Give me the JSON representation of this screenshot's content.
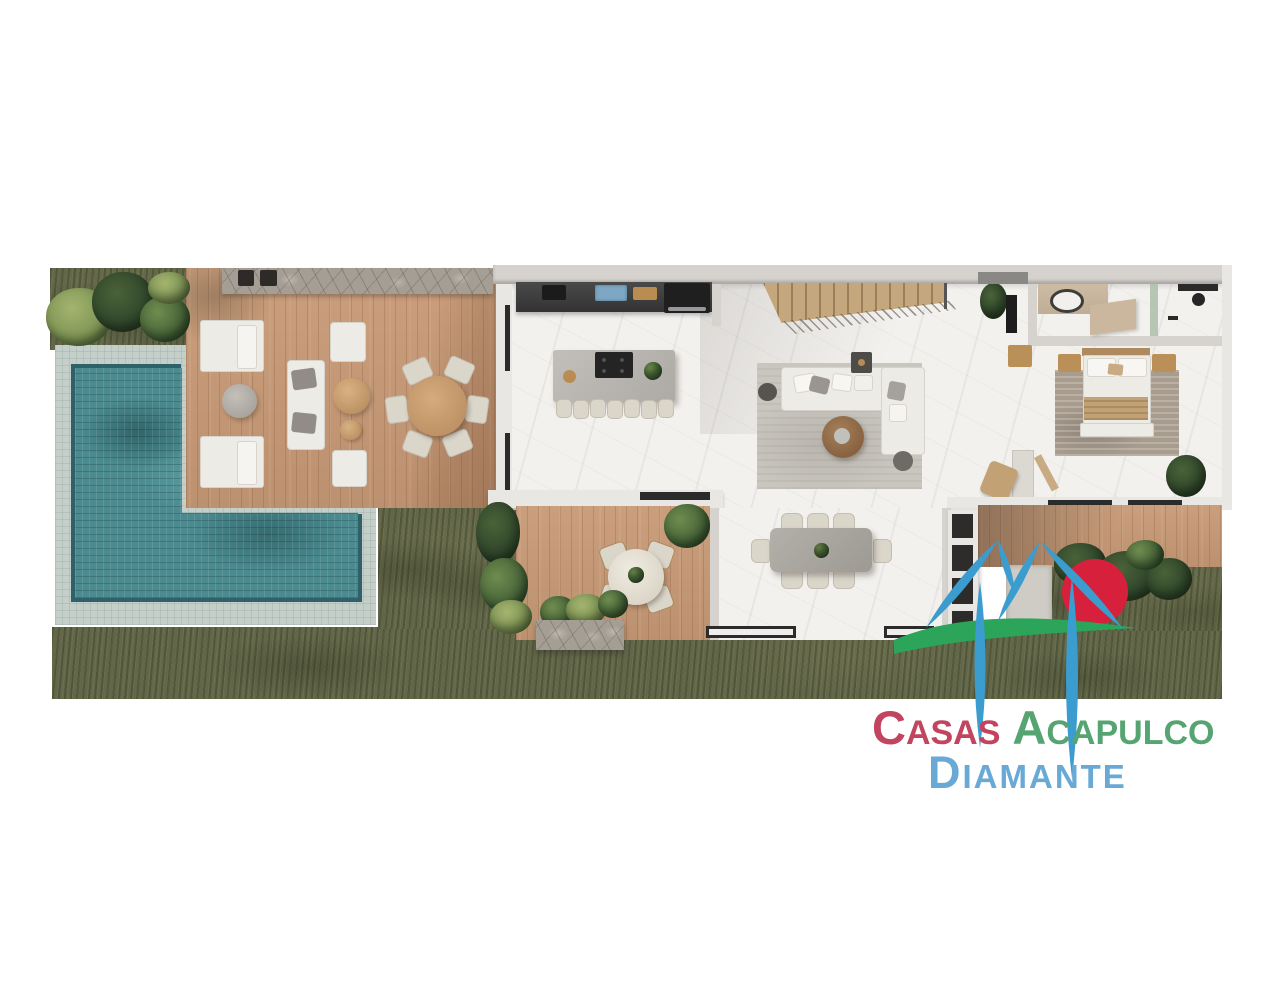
{
  "page": {
    "width": 1280,
    "height": 989,
    "background": "#ffffff"
  },
  "logo": {
    "line1_word1": "Casas",
    "line1_word2": "Acapulco",
    "line2": "Diamante",
    "colors": {
      "casas": "#c24560",
      "acapulco": "#55a471",
      "diamante": "#69a9d5",
      "mark_blue": "#3b9ccf",
      "mark_red": "#d7203b",
      "mark_green": "#2ca45a"
    }
  },
  "palette": {
    "grass": "#636749",
    "wood": "#c89a76",
    "stairs_wood": "#c4a77c",
    "marble": "#f3f1ee",
    "wall": "#d6d3cf",
    "wall_white": "#e9e7e3",
    "stone": "#a49e94",
    "pool_tile": "#c4cfca",
    "water": "#4b8b90",
    "water_rim": "#2e6168",
    "rug": "#c9c6bf",
    "rug_bedroom": "#a89c8f",
    "sofa": "#edebe6",
    "island": "#b3b0ab",
    "counter_dark": "#383838",
    "table_gray": "#a6a39c",
    "chair_cream": "#dbd6ca",
    "furniture_wood": "#bb9058",
    "blanket": "#c2a275",
    "headboard": "#b08a5f",
    "plant_dark": "#233a22",
    "plant_mid": "#49663a",
    "plant_light": "#6f8c4f",
    "planter_stone": "#9d968c",
    "path_concrete": "#cfccc6",
    "glass_dark": "#2b2b2b"
  },
  "scene_features": [
    "l-shaped-pool",
    "pool-deck",
    "sun-loungers",
    "outdoor-sofa-set",
    "round-outdoor-dining-table",
    "stone-feature-wall",
    "kitchen-counter",
    "kitchen-island-with-stools",
    "staircase",
    "living-room-sectional",
    "dining-table-8-seats",
    "breakfast-patio-table",
    "bedroom-king-bed",
    "bathroom-vanity",
    "shower",
    "garden-lawn",
    "tropical-planting",
    "stone-planter",
    "rear-deck"
  ]
}
